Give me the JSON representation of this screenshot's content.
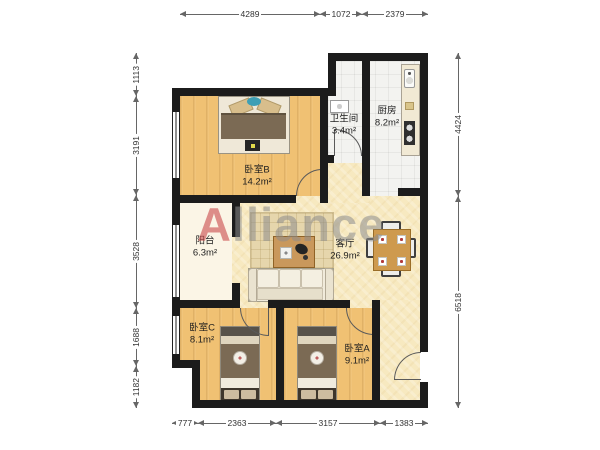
{
  "watermark": {
    "accent": "A",
    "rest": "lliance",
    "accent_color": "#c94d4d",
    "text_color": "#8c8c8c"
  },
  "rooms": {
    "bedroomB": {
      "name": "卧室B",
      "area": "14.2m²"
    },
    "bathroom": {
      "name": "卫生间",
      "area": "3.4m²"
    },
    "kitchen": {
      "name": "厨房",
      "area": "8.2m²"
    },
    "balcony": {
      "name": "阳台",
      "area": "6.3m²"
    },
    "living": {
      "name": "客厅",
      "area": "26.9m²"
    },
    "bedroomC": {
      "name": "卧室C",
      "area": "8.1m²"
    },
    "bedroomA": {
      "name": "卧室A",
      "area": "9.1m²"
    }
  },
  "dimensions": {
    "top": [
      "4289",
      "1072",
      "2379"
    ],
    "bottom": [
      "777",
      "2363",
      "3157",
      "1383"
    ],
    "left": [
      "1113",
      "3191",
      "3528",
      "1688",
      "1182"
    ],
    "right": [
      "4424",
      "6518"
    ]
  },
  "colors": {
    "wall": "#1c1c1c",
    "wood_floor": "#f0c173",
    "living_floor": "#f7e9c0",
    "tile_floor": "#f3f3f0",
    "balcony_floor": "#fbf5e6"
  }
}
